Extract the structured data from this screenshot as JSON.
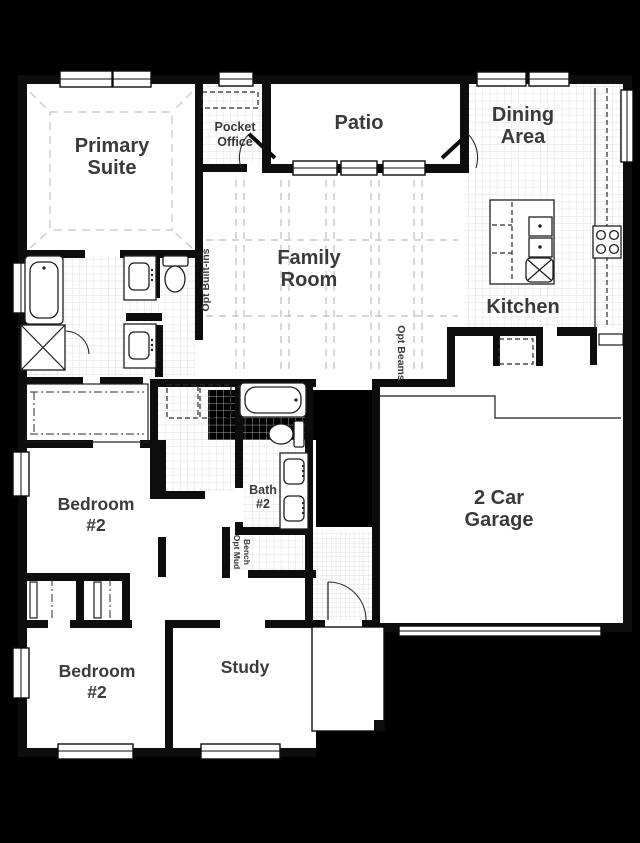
{
  "canvas": {
    "width": 640,
    "height": 843
  },
  "colors": {
    "background": "#000000",
    "floor": "#ffffff",
    "wall": "#0d0d0d",
    "tile_grid": "#d8d8d8",
    "beam_dash": "#bdbdbd",
    "label_text": "#3a3a3a"
  },
  "rooms": {
    "primary_suite": {
      "line1": "Primary",
      "line2": "Suite"
    },
    "pocket_office": {
      "line1": "Pocket",
      "line2": "Office"
    },
    "patio": {
      "label": "Patio"
    },
    "dining_area": {
      "line1": "Dining",
      "line2": "Area"
    },
    "family_room": {
      "line1": "Family",
      "line2": "Room"
    },
    "kitchen": {
      "label": "Kitchen"
    },
    "garage": {
      "line1": "2 Car",
      "line2": "Garage"
    },
    "bath_2": {
      "line1": "Bath",
      "line2": "#2"
    },
    "bedroom_2_upper": {
      "line1": "Bedroom",
      "line2": "#2"
    },
    "bedroom_2_lower": {
      "line1": "Bedroom",
      "line2": "#2"
    },
    "study": {
      "label": "Study"
    }
  },
  "annotations": {
    "opt_built_ins": "Opt Built-ins",
    "opt_beams": "Opt Beams",
    "opt_mud_bench_line1": "Opt Mud",
    "opt_mud_bench_line2": "Bench"
  }
}
